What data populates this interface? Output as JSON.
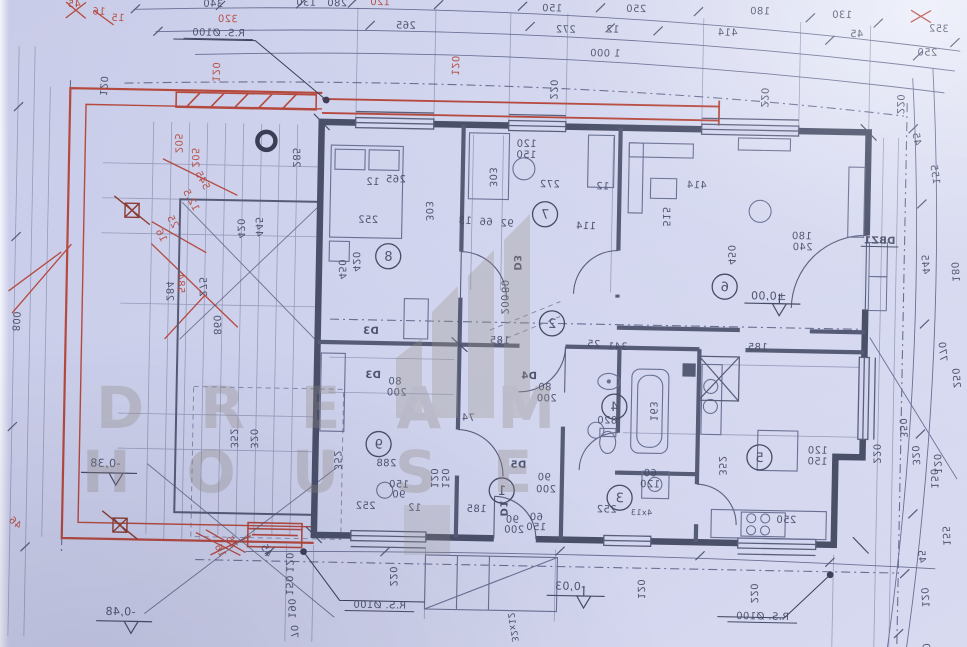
{
  "image": {
    "description": "photographed architectural floor plan, mirrored print on blue paper"
  },
  "watermark": {
    "line1": "DREAM",
    "line2": "HOUSE"
  },
  "colors": {
    "paper": "#cdd1ec",
    "ink": "#474c66",
    "wall": "#4b5069",
    "red": "#b5493e",
    "watermark": "#8f8982"
  },
  "plan": {
    "scale_note": "1 000",
    "pipe_note": "R.S. Ø100",
    "levels": [
      "±0,00",
      "-0,03",
      "-0,38",
      "-0,48"
    ],
    "doors": [
      "D1",
      "D3",
      "D4",
      "D5",
      "DBZ1"
    ],
    "stairs_note": "32x12"
  },
  "rooms": [
    {
      "number": "1",
      "x": 505,
      "y": 490
    },
    {
      "number": "2",
      "x": 552,
      "y": 322
    },
    {
      "number": "3",
      "x": 623,
      "y": 495
    },
    {
      "number": "4",
      "x": 616,
      "y": 404
    },
    {
      "number": "5",
      "x": 762,
      "y": 452
    },
    {
      "number": "6",
      "x": 724,
      "y": 282
    },
    {
      "number": "7",
      "x": 543,
      "y": 213
    },
    {
      "number": "8",
      "x": 387,
      "y": 258
    },
    {
      "number": "9",
      "x": 381,
      "y": 446
    }
  ],
  "labels": [
    {
      "t": "340",
      "x": 207,
      "y": 12
    },
    {
      "t": "130",
      "x": 300,
      "y": 9
    },
    {
      "t": "280",
      "x": 331,
      "y": 9
    },
    {
      "t": "120",
      "x": 374,
      "y": 7,
      "c": "r"
    },
    {
      "t": "320",
      "x": 222,
      "y": 27,
      "c": "r"
    },
    {
      "t": "45",
      "x": 68,
      "y": 15,
      "c": "r"
    },
    {
      "t": "16",
      "x": 93,
      "y": 22,
      "c": "r"
    },
    {
      "t": "15",
      "x": 112,
      "y": 28,
      "c": "r"
    },
    {
      "t": "150",
      "x": 546,
      "y": 10
    },
    {
      "t": "250",
      "x": 630,
      "y": 9
    },
    {
      "t": "180",
      "x": 754,
      "y": 9
    },
    {
      "t": "130",
      "x": 836,
      "y": 11
    },
    {
      "t": "265",
      "x": 400,
      "y": 30
    },
    {
      "t": "272",
      "x": 560,
      "y": 31
    },
    {
      "t": "12",
      "x": 607,
      "y": 30
    },
    {
      "t": "414",
      "x": 722,
      "y": 31
    },
    {
      "t": "45",
      "x": 851,
      "y": 30
    },
    {
      "t": "352",
      "x": 933,
      "y": 23
    },
    {
      "t": "250",
      "x": 922,
      "y": 47
    },
    {
      "t": "1 000",
      "x": 600,
      "y": 54
    },
    {
      "t": "R.S. Ø100",
      "x": 213,
      "y": 41,
      "u": 1
    },
    {
      "t": "220",
      "x": 546,
      "y": 88,
      "r": 90
    },
    {
      "t": "220",
      "x": 757,
      "y": 92,
      "r": 90
    },
    {
      "t": "220",
      "x": 893,
      "y": 96,
      "r": 90
    },
    {
      "t": "120",
      "x": 447,
      "y": 66,
      "r": 90,
      "c": "r"
    },
    {
      "t": "120",
      "x": 208,
      "y": 77,
      "r": 90,
      "c": "r"
    },
    {
      "t": "45",
      "x": 910,
      "y": 131,
      "r": 80
    },
    {
      "t": "155",
      "x": 929,
      "y": 166,
      "r": 80
    },
    {
      "t": "445",
      "x": 921,
      "y": 256,
      "r": 84
    },
    {
      "t": "180",
      "x": 951,
      "y": 263,
      "r": 84
    },
    {
      "t": "770",
      "x": 940,
      "y": 343,
      "r": 84
    },
    {
      "t": "250",
      "x": 954,
      "y": 369,
      "r": 84
    },
    {
      "t": "350",
      "x": 902,
      "y": 420,
      "r": 86
    },
    {
      "t": "320",
      "x": 915,
      "y": 447,
      "r": 86
    },
    {
      "t": "120",
      "x": 937,
      "y": 455,
      "r": 86
    },
    {
      "t": "150",
      "x": 934,
      "y": 470,
      "r": 86
    },
    {
      "t": "155",
      "x": 947,
      "y": 527,
      "r": 85
    },
    {
      "t": "45",
      "x": 923,
      "y": 548,
      "r": 85
    },
    {
      "t": "120",
      "x": 927,
      "y": 589,
      "r": 85
    },
    {
      "t": "0",
      "x": 929,
      "y": 638,
      "r": 85
    },
    {
      "t": "DBZ1",
      "x": 878,
      "y": 236,
      "b": 1,
      "u": 1
    },
    {
      "t": "180",
      "x": 800,
      "y": 233
    },
    {
      "t": "240",
      "x": 801,
      "y": 244
    },
    {
      "t": "800",
      "x": 13,
      "y": 330,
      "r": 92
    },
    {
      "t": "120",
      "x": 96,
      "y": 93,
      "r": 92
    },
    {
      "t": "46",
      "x": 17,
      "y": 534,
      "c": "r",
      "r": 40
    },
    {
      "t": "205",
      "x": 172,
      "y": 149,
      "c": "r",
      "r": 88
    },
    {
      "t": "205",
      "x": 189,
      "y": 163,
      "c": "r",
      "r": 88
    },
    {
      "t": "545",
      "x": 197,
      "y": 187,
      "c": "r",
      "r": 60
    },
    {
      "t": "12,5",
      "x": 186,
      "y": 207,
      "c": "r",
      "r": 60
    },
    {
      "t": "25",
      "x": 168,
      "y": 229,
      "c": "r",
      "r": 60
    },
    {
      "t": "16",
      "x": 157,
      "y": 243,
      "c": "r",
      "r": 60
    },
    {
      "t": "584",
      "x": 177,
      "y": 289,
      "c": "r",
      "r": 88
    },
    {
      "t": "284",
      "x": 166,
      "y": 297,
      "r": 88
    },
    {
      "t": "275",
      "x": 199,
      "y": 292,
      "r": 88
    },
    {
      "t": "860",
      "x": 214,
      "y": 330,
      "r": 88
    },
    {
      "t": "352",
      "x": 233,
      "y": 443,
      "r": 88
    },
    {
      "t": "320",
      "x": 253,
      "y": 443,
      "r": 88
    },
    {
      "t": "285",
      "x": 290,
      "y": 161,
      "r": 88
    },
    {
      "t": "445",
      "x": 254,
      "y": 231,
      "r": 88
    },
    {
      "t": "420",
      "x": 236,
      "y": 233,
      "r": 88
    },
    {
      "t": "265",
      "x": 393,
      "y": 184
    },
    {
      "t": "303",
      "x": 424,
      "y": 212,
      "r": 88
    },
    {
      "t": "252",
      "x": 366,
      "y": 225
    },
    {
      "t": "420",
      "x": 352,
      "y": 264,
      "r": 88
    },
    {
      "t": "450",
      "x": 338,
      "y": 272,
      "r": 88
    },
    {
      "t": "12",
      "x": 370,
      "y": 187
    },
    {
      "t": "120",
      "x": 523,
      "y": 146
    },
    {
      "t": "150",
      "x": 523,
      "y": 157
    },
    {
      "t": "303",
      "x": 487,
      "y": 177,
      "r": 88
    },
    {
      "t": "272",
      "x": 547,
      "y": 186
    },
    {
      "t": "12",
      "x": 600,
      "y": 187
    },
    {
      "t": "13",
      "x": 463,
      "y": 224
    },
    {
      "t": "66",
      "x": 484,
      "y": 225
    },
    {
      "t": "92",
      "x": 505,
      "y": 226
    },
    {
      "t": "114",
      "x": 584,
      "y": 227
    },
    {
      "t": "414",
      "x": 694,
      "y": 184
    },
    {
      "t": "450",
      "x": 727,
      "y": 250,
      "r": 88
    },
    {
      "t": "515",
      "x": 661,
      "y": 213,
      "r": 88
    },
    {
      "t": "±0,00",
      "x": 768,
      "y": 294,
      "s": 11
    },
    {
      "t": "341",
      "x": 618,
      "y": 347
    },
    {
      "t": "25",
      "x": 594,
      "y": 345
    },
    {
      "t": "185",
      "x": 500,
      "y": 343
    },
    {
      "t": "D3",
      "x": 513,
      "y": 262,
      "b": 1,
      "r": 88
    },
    {
      "t": "80",
      "x": 501,
      "y": 286,
      "r": 88
    },
    {
      "t": "200",
      "x": 501,
      "y": 304,
      "r": 88
    },
    {
      "t": "D3",
      "x": 371,
      "y": 336,
      "b": 1
    },
    {
      "t": "D3",
      "x": 374,
      "y": 380,
      "b": 1
    },
    {
      "t": "80",
      "x": 396,
      "y": 386
    },
    {
      "t": "200",
      "x": 398,
      "y": 397
    },
    {
      "t": "D4",
      "x": 530,
      "y": 378,
      "b": 1
    },
    {
      "t": "80",
      "x": 546,
      "y": 389
    },
    {
      "t": "200",
      "x": 548,
      "y": 400
    },
    {
      "t": "D5",
      "x": 521,
      "y": 467,
      "b": 1
    },
    {
      "t": "90",
      "x": 547,
      "y": 479
    },
    {
      "t": "200",
      "x": 549,
      "y": 491
    },
    {
      "t": "D1",
      "x": 504,
      "y": 508,
      "b": 1,
      "r": 88
    },
    {
      "t": "90",
      "x": 516,
      "y": 522
    },
    {
      "t": "200",
      "x": 518,
      "y": 532
    },
    {
      "t": "74",
      "x": 470,
      "y": 421
    },
    {
      "t": "120",
      "x": 434,
      "y": 479,
      "r": 88
    },
    {
      "t": "150",
      "x": 445,
      "y": 479,
      "r": 88
    },
    {
      "t": "352",
      "x": 337,
      "y": 463,
      "r": 88
    },
    {
      "t": "288",
      "x": 389,
      "y": 468
    },
    {
      "t": "150",
      "x": 402,
      "y": 489
    },
    {
      "t": "90",
      "x": 402,
      "y": 499
    },
    {
      "t": "252",
      "x": 369,
      "y": 511
    },
    {
      "t": "12",
      "x": 418,
      "y": 512
    },
    {
      "t": "185",
      "x": 480,
      "y": 512
    },
    {
      "t": "252",
      "x": 610,
      "y": 510
    },
    {
      "t": "4x13",
      "x": 645,
      "y": 512,
      "s": 8
    },
    {
      "t": "60",
      "x": 540,
      "y": 519
    },
    {
      "t": "150",
      "x": 540,
      "y": 529
    },
    {
      "t": "163",
      "x": 652,
      "y": 408,
      "r": 88
    },
    {
      "t": "820",
      "x": 609,
      "y": 421
    },
    {
      "t": "60",
      "x": 653,
      "y": 473
    },
    {
      "t": "120",
      "x": 653,
      "y": 484
    },
    {
      "t": "352",
      "x": 722,
      "y": 461,
      "r": 88
    },
    {
      "t": "250",
      "x": 790,
      "y": 517
    },
    {
      "t": "120",
      "x": 820,
      "y": 447
    },
    {
      "t": "150",
      "x": 820,
      "y": 458
    },
    {
      "t": "220",
      "x": 876,
      "y": 446,
      "r": 88
    },
    {
      "t": "185",
      "x": 758,
      "y": 345
    },
    {
      "t": "-0,03",
      "x": 575,
      "y": 588,
      "s": 11
    },
    {
      "t": "-0,38",
      "x": 108,
      "y": 474,
      "s": 11
    },
    {
      "t": "-0,48",
      "x": 126,
      "y": 622,
      "s": 11
    },
    {
      "t": "R.S. Ø100",
      "x": 385,
      "y": 610,
      "u": 1
    },
    {
      "t": "R.S. Ø100",
      "x": 768,
      "y": 614,
      "u": 1
    },
    {
      "t": "220",
      "x": 395,
      "y": 578,
      "r": 88
    },
    {
      "t": "220",
      "x": 756,
      "y": 588,
      "r": 88
    },
    {
      "t": "120",
      "x": 643,
      "y": 586,
      "r": 88
    },
    {
      "t": "120",
      "x": 291,
      "y": 566,
      "r": 88
    },
    {
      "t": "150",
      "x": 291,
      "y": 589,
      "r": 88
    },
    {
      "t": "190",
      "x": 294,
      "y": 612,
      "r": 88
    },
    {
      "t": "70",
      "x": 297,
      "y": 635,
      "r": 88
    },
    {
      "t": "45",
      "x": 268,
      "y": 556,
      "r": 60
    },
    {
      "t": "25",
      "x": 233,
      "y": 548,
      "c": "r",
      "r": 60
    },
    {
      "t": "16",
      "x": 222,
      "y": 557,
      "c": "r",
      "r": 60
    },
    {
      "t": "32x12",
      "x": 516,
      "y": 627,
      "r": 80,
      "s": 9
    }
  ]
}
